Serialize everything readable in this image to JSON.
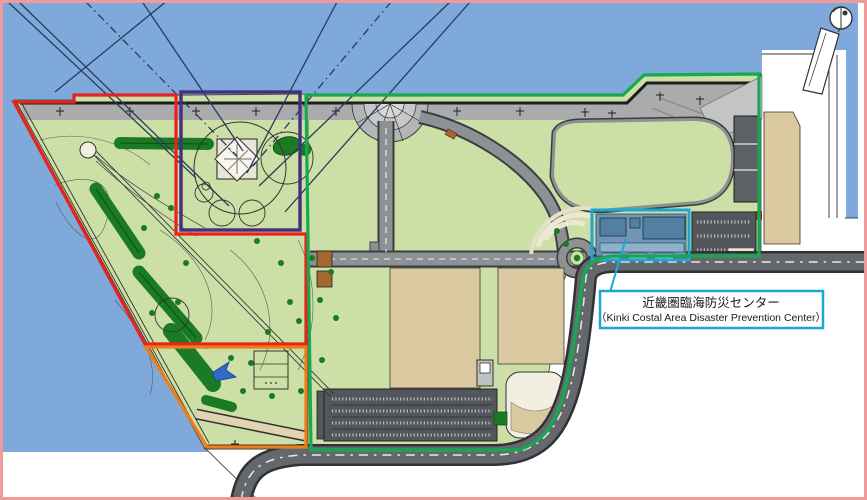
{
  "map": {
    "annotation": {
      "jp": "近畿圏臨海防災センター",
      "en": "（Kinki Costal Area Disaster Prevention Center）"
    },
    "colors": {
      "water": "#7FA8DB",
      "park_green": "#CBDFA6",
      "tree_green": "#1B7B24",
      "promenade_gray": "#A9ABAD",
      "road_gray": "#8E9194",
      "main_road_gray": "#64686C",
      "road_edge": "#2F3336",
      "plot_tan": "#D9C8A0",
      "parking_dark": "#53575B",
      "compound_ground_blue": "#7195B5",
      "building_blue": "#557FA0",
      "red_boundary": "#E8221C",
      "orange_boundary": "#EE7D18",
      "purple_boundary": "#45307E",
      "green_boundary": "#17A94F",
      "teal_highlight": "#1BA8D5",
      "page_border_pink": "#F09B9B",
      "cream": "#EFEAD8"
    }
  }
}
